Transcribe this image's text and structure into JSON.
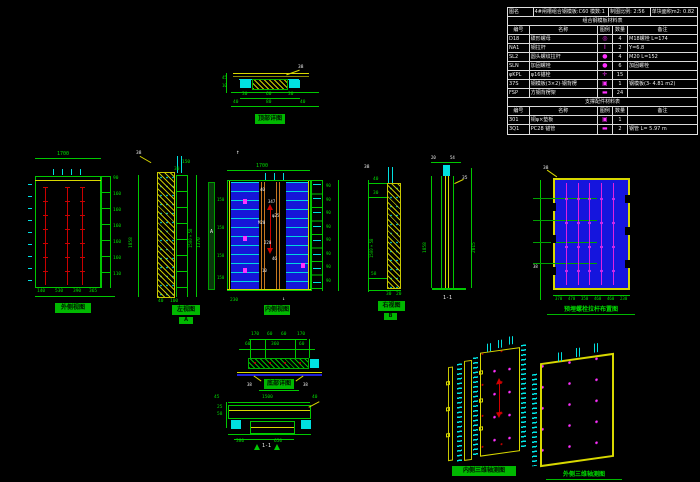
{
  "canvas": {
    "width": 700,
    "height": 482,
    "bg": "#000000"
  },
  "colors": {
    "green": "#00c800",
    "cyan": "#00e0e0",
    "yellow": "#d8d800",
    "red": "#d00000",
    "blue": "#1515dd",
    "magenta": "#ff30ff",
    "white": "#eeeeee"
  },
  "table": {
    "header": [
      "图名",
      "4#闸槽组合钢模板:C60 模数:1",
      "制图比例: 2:56",
      "单块面积m2: 0.82"
    ],
    "section1": {
      "title": "组合钢模板材料表",
      "columns": [
        "编号",
        "名称",
        "图例",
        "数量",
        "备注"
      ],
      "rows": [
        {
          "id": "D18",
          "name": "碟形螺母",
          "sym": "◎",
          "qty": "4",
          "note": "M18螺栓 L=174"
        },
        {
          "id": "NA1",
          "name": "钢拉杆",
          "sym": "Ⅰ",
          "qty": "2",
          "note": "Y=6.8"
        },
        {
          "id": "SL2",
          "name": "圆头螺纹拉杆",
          "sym": "●",
          "qty": "4",
          "note": "M20 L=152"
        },
        {
          "id": "SLN",
          "name": "加固螺栓",
          "sym": "●",
          "qty": "6",
          "note": "加固螺栓"
        },
        {
          "id": "φKPL",
          "name": "φ16锚栓",
          "sym": "✛",
          "qty": "15",
          "note": ""
        },
        {
          "id": "37S",
          "name": "钢模板(3×2)·钢背楞",
          "sym": "▣",
          "qty": "1",
          "note": "钢模板(3- 4.81 m2)"
        },
        {
          "id": "FSP",
          "name": "方钢背楞架",
          "sym": "▬",
          "qty": "24",
          "note": ""
        }
      ]
    },
    "section2": {
      "title": "支撑配件材料表",
      "columns": [
        "编号",
        "名称",
        "图例",
        "数量",
        "备注"
      ],
      "rows": [
        {
          "id": "301",
          "name": "铜φ×垫板",
          "sym": "▣",
          "qty": "1",
          "note": ""
        },
        {
          "id": "3Q1",
          "name": "PC28 锚管",
          "sym": "▬",
          "qty": "2",
          "note": "钢管 L= 5.97 m"
        }
      ]
    }
  },
  "d_top": {
    "label": "顶部详图",
    "leader": "38",
    "dims1": [
      "30",
      "60",
      "30"
    ],
    "dims2": [
      "40",
      "80",
      "40"
    ],
    "side_dims": [
      "45",
      "10"
    ]
  },
  "d_left": {
    "label": "外侧视图",
    "top_dim": "1700",
    "right_dims": [
      "90",
      "160",
      "160",
      "160",
      "160",
      "160",
      "110"
    ],
    "bottom_dims": [
      "140",
      "530",
      "390",
      "365"
    ]
  },
  "d_lsec": {
    "label": "左视图",
    "sub": "A",
    "leader": "38",
    "dim_left": "1858",
    "dim_outer": "1370",
    "dim_inner": "1500×58",
    "top_dims": [
      "150",
      "30"
    ],
    "bottom_dims": [
      "40",
      "100"
    ]
  },
  "d_center": {
    "label": "内侧视图",
    "top_dim": "1700",
    "north": "↑",
    "section": "A",
    "marker": "↓",
    "left_dims": [
      "150",
      "150",
      "150",
      "150"
    ],
    "right_dims": [
      "90",
      "90",
      "90",
      "90",
      "90",
      "90",
      "90",
      "90"
    ],
    "bottom_dim": "230",
    "ann": [
      "40",
      "347",
      "φ25",
      "M20",
      "220",
      "46",
      "10"
    ]
  },
  "d_rsec": {
    "label": "右视图",
    "sub": "B",
    "leader": "38",
    "dim_left": "1500×58",
    "top_dims": [
      "40",
      "30"
    ],
    "bottom_dims": [
      "58",
      "30",
      "20"
    ]
  },
  "d_nsec": {
    "label": "1-1",
    "top_dims": [
      "20",
      "54"
    ],
    "leader": "35",
    "dim_left": "1858",
    "dim_right": "2015"
  },
  "d_blue": {
    "label": "预埋螺栓拉杆布置图",
    "leader": "38",
    "leader2": "38",
    "bottom_dims": [
      "370",
      "470",
      "350",
      "460",
      "460",
      "230"
    ]
  },
  "d_mid": {
    "label": "底部详图",
    "dims1": [
      "170",
      "60",
      "60",
      "170"
    ],
    "dims2": [
      "60",
      "360",
      "60"
    ],
    "leader_l": "38",
    "leader_r": "38"
  },
  "d_bot": {
    "label": "1-1",
    "top_dim": "1500",
    "end_dims": [
      "45",
      "40"
    ],
    "left_dims": [
      "25",
      "58"
    ],
    "bottom_dims": [
      "380",
      "650"
    ]
  },
  "d_axo1": {
    "label": "内侧三维轴测图"
  },
  "d_axo2": {
    "label": "外侧三维轴测图"
  }
}
